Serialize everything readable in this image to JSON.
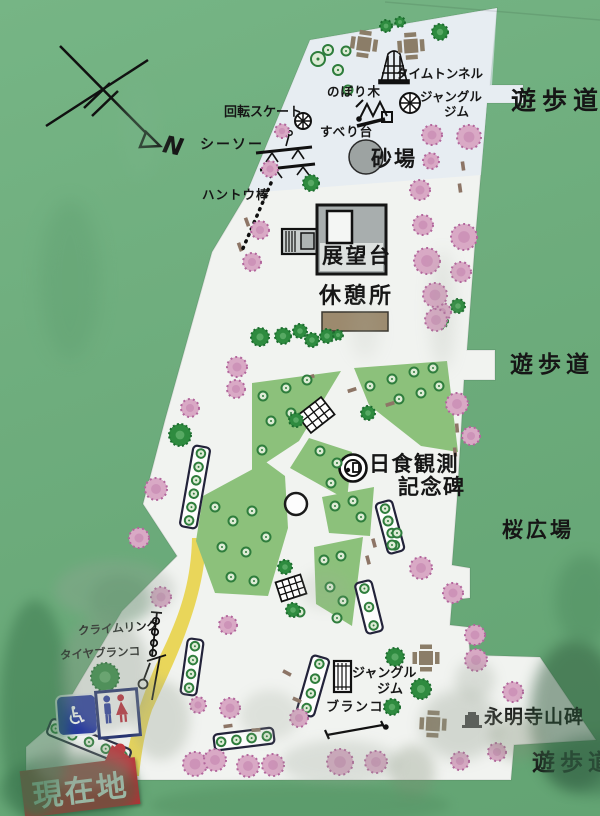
{
  "board": {
    "type": "park-guide-map-sign",
    "colors": {
      "board_green": "#6fae7e",
      "map_white": "#f1f3f0",
      "plaza_green": "#8cc17b",
      "cherry_pink": "#d9a9c5",
      "tree_green": "#2e8b3f",
      "path_yellow": "#e8d44d",
      "sign_red": "#bf2b33",
      "sign_blue": "#2133a2",
      "table_brown": "#8b7d68",
      "sandbox_gray": "#9da3a2"
    }
  },
  "compass": {
    "north": "N"
  },
  "labels": {
    "walkway_top": "遊歩道",
    "walkway_mid": "遊歩道",
    "walkway_bottom": "遊歩道",
    "sakura_plaza": "桜広場",
    "eimeiji_monument": "永明寺山碑",
    "time_tunnel": "タイムトンネル",
    "climbing_tree": "のぼり木",
    "jungle_gym_top_line1": "ジャングル",
    "jungle_gym_top_line2": "ジム",
    "rotating_skate": "回転スケート",
    "slide": "すべり台",
    "seesaw": "シーソー",
    "sandbox": "砂場",
    "hanging_pole": "ハントウ棒",
    "observation_deck": "展望台",
    "rest_area": "休憩所",
    "eclipse_monument_line1": "日食観測",
    "eclipse_monument_line2": "記念碑",
    "climb_ring": "クライムリング",
    "tire_swing": "タイヤブランコ",
    "jungle_gym_bottom_line1": "ジャングル",
    "jungle_gym_bottom_line2": "ジム",
    "swing": "ブランコ",
    "current_location": "現在地"
  },
  "icons": {
    "wheelchair": "♿"
  }
}
